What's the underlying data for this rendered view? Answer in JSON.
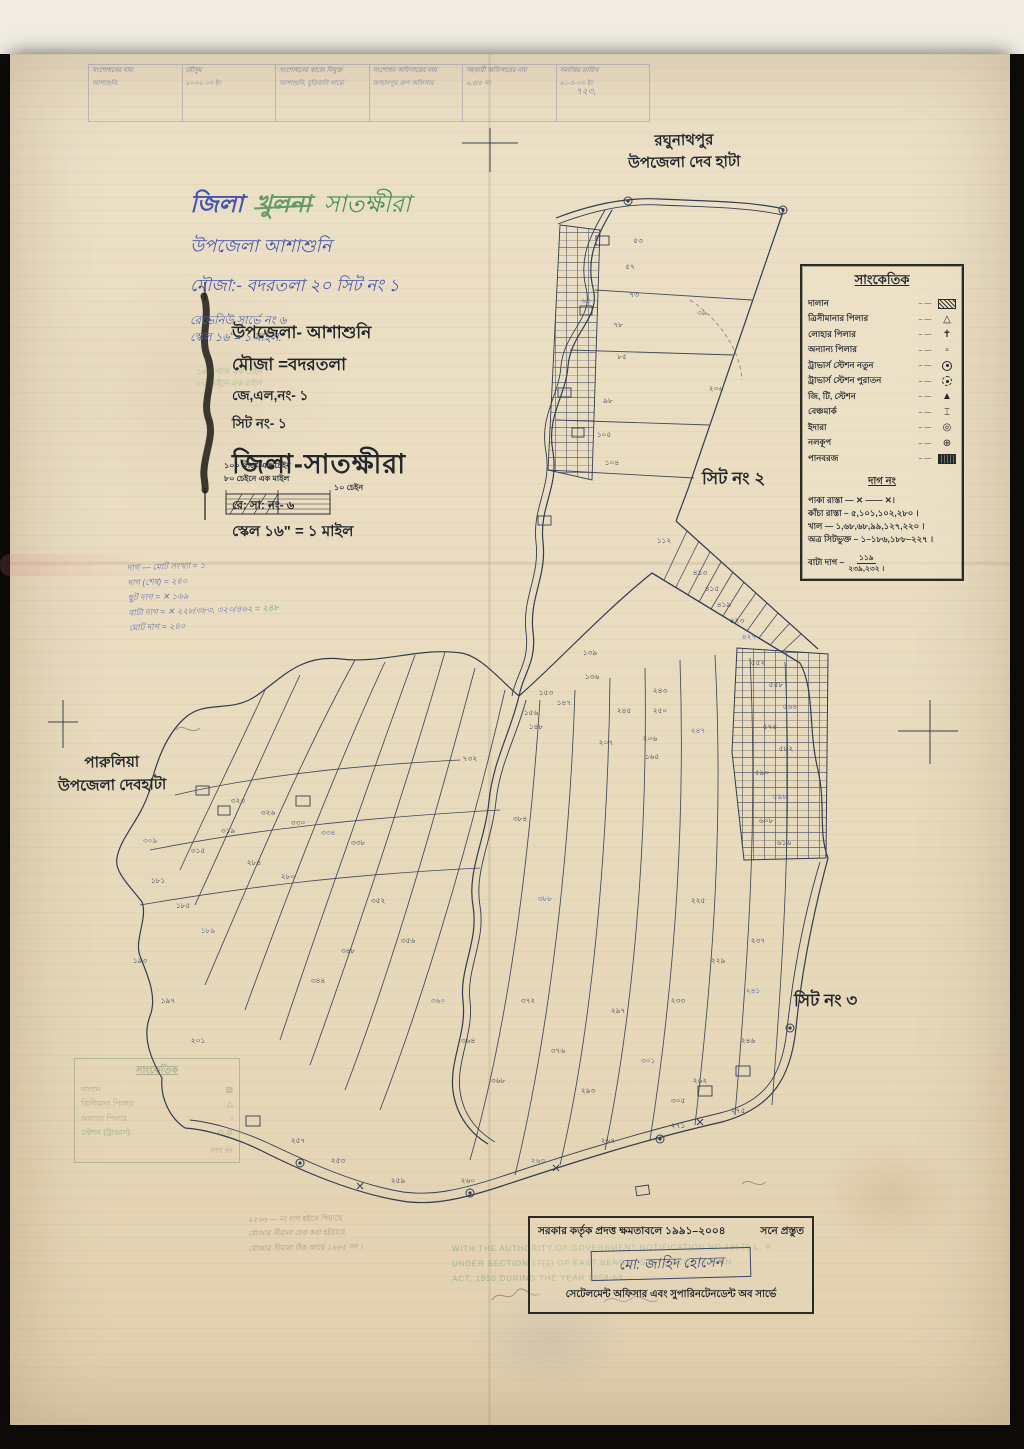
{
  "colors": {
    "ink": "#323c52",
    "blue": "#4a5fae",
    "green": "#3f8a52",
    "paper": "#e9dcc1"
  },
  "annot_table": {
    "dots": "–  —",
    "cells": [
      {
        "top": "সংশোধনের নাম:",
        "bottom": "আশাশুনি:"
      },
      {
        "top": "মৌসুম",
        "bottom": "২০০২-০৩ ইং"
      },
      {
        "top": "সংশোধনের কাজে নিযুক্ত",
        "bottom": "আশাশুনি, বুড়িবাটা সার্ভে"
      },
      {
        "top": "সংশোধন অফিসারের নাম",
        "bottom": "জাহানপুর গ্রুপ অফিসার"
      },
      {
        "top": "সহকারী অফিসারের নাম",
        "bottom": "৬,৫/৫ নং"
      },
      {
        "top": "সমাপ্তির তারিখ",
        "bottom": "৬১-৪-০৩ ইং"
      }
    ],
    "extra": "৭২৩,"
  },
  "hand_title": {
    "district_label": "জিলা",
    "old_district": "খুলনা",
    "new_district": "সাতক্ষীরা",
    "line2": "উপজেলা আশাশুনি",
    "line3": "মৌজা:- বদরতলা ২০ সিট নং ১",
    "rev1": "রেভেনিউ সার্ভে নং ৬",
    "rev2": "স্কেল ১৬\"= ১ মাইল."
  },
  "print_title": {
    "upazila": "উপজেলা- আশাশুনি",
    "mouza": "মৌজা =বদরতলা",
    "jl": "জে,এল,নং- ১",
    "sheet": "সিট নং- ১",
    "district": "জিলা-সাতক্ষীরা",
    "rs": "রে: সা: নং- ৬",
    "scale": "স্কেল ১৬\" = ১ মাইল",
    "chain1": "১০০ লিঙ্কে এক চেইন",
    "chain2": "৮০ চেইনে এক মাইল",
    "scalebar_label": "১০ চেইন",
    "ghost1": "১৬০ গজে এক চেইন",
    "ghost2": "৮০ চেইনে এক মাইল"
  },
  "places": {
    "top_right1": "রঘুনাথপুর",
    "top_right2": "উপজেলা দেব হাটা",
    "sheet2": "সিট নং ২",
    "left1": "পারুলিয়া",
    "left2": "উপজেলা দেবহাটা",
    "sheet3": "সিট নং ৩"
  },
  "legend": {
    "title": "সাংকেতিক",
    "dots": "–  —",
    "items": [
      {
        "label": "দালান",
        "sym": "hatch"
      },
      {
        "label": "ত্রিসীমানার পিলার",
        "sym": "tri"
      },
      {
        "label": "লোহার পিলার",
        "sym": "cross"
      },
      {
        "label": "অন্যান্য পিলার",
        "sym": "sq"
      },
      {
        "label": "ট্রাভার্স স্টেশন নতুন",
        "sym": "circdot"
      },
      {
        "label": "ট্রাভার্স স্টেশন পুরাতন",
        "sym": "circdash"
      },
      {
        "label": "জি, টি, স্টেশন",
        "sym": "tridark"
      },
      {
        "label": "বেঞ্চমার্ক",
        "sym": "bench"
      },
      {
        "label": "ইদারা",
        "sym": "well"
      },
      {
        "label": "নলকূপ",
        "sym": "tube"
      },
      {
        "label": "পানবরজ",
        "sym": "darkhatch"
      }
    ],
    "dag_title": "দাগ নং",
    "dag_lines": [
      "পাকা রাস্তা — ✕ —— ✕।",
      "কাঁচা রাস্তা – ৫,১০১,১০২,২৮০ ।",
      "খাল — ১,৬৮,৬৮,৯৯,১২৭,২২০ ।",
      "অত্র সিটভুক্ত – ১–১৮৬,১৮৮–২২৭ ।"
    ],
    "bata_label": "বাটা দাগ –",
    "bata_num": "১১৯",
    "bata_den": "২৩৯,২৩২ ।"
  },
  "blue_notes": [
    "দাগ — মোট সংখ্যা =  ১",
    "দাগ (শেষ) =  ২৪০",
    "ছুট দাগ =  ✕ ১৬৯",
    "বাটা দাগ =  ✕ ২২৮/৩৮৩, ৩২০/৪৬২",
    "মোট দাগ =  ২৪০"
  ],
  "blue_notes_teal": "= ২৪৮",
  "ghost_legend": {
    "title": "সাংকেতিক",
    "rows": [
      {
        "label": "দালান",
        "sym": "▨"
      },
      {
        "label": "ত্রিসীমানা পিলার",
        "sym": "△"
      },
      {
        "label": "অন্যান্য পিলার",
        "sym": "▫"
      },
      {
        "label": "স্টেশন (ট্রাভার্স)",
        "sym": "⊙ ⊙"
      }
    ],
    "footer": "দাগ নং"
  },
  "stamp": {
    "line1": "সরকার কর্তৃক প্রদত্ত ক্ষমতাবলে ১৯৯১–২০০৪",
    "line1b": "সনে প্রস্তুত",
    "name": "মো: জাহিদ হোসেন",
    "line3": "সেটেলমেন্ট অফিসার এবং সুপারিনটেনডেন্ট অব সার্ভে",
    "ghost_lines": [
      "WITH THE AUTHORITY OF GOVERNMENT NOTIFICATION NO 19636 L. R.",
      "UNDER SECTION 17(1) OF EAST BENGAL STATE ACQUISITION",
      "ACT, 1950 DURING THE YEAR 1958-63"
    ]
  },
  "pencil_notes": [
    "২২৬৬ — নং দাগ হইতে গিয়াছে",
    "মৌজার সীমানা চেক করা হইয়াছে",
    "মৌজার সীমানা ঠিক আছে ১৯৬৫ সন ।"
  ],
  "map": {
    "labels": [
      {
        "x": 638,
        "y": 242,
        "t": "৫৩"
      },
      {
        "x": 630,
        "y": 268,
        "t": "৫৭"
      },
      {
        "x": 634,
        "y": 296,
        "t": "৭৩"
      },
      {
        "x": 618,
        "y": 326,
        "t": "৭৮"
      },
      {
        "x": 622,
        "y": 358,
        "t": "৮৫"
      },
      {
        "x": 608,
        "y": 402,
        "t": "৯৮"
      },
      {
        "x": 604,
        "y": 436,
        "t": "১০৫"
      },
      {
        "x": 612,
        "y": 464,
        "t": "১০৪"
      },
      {
        "x": 702,
        "y": 314,
        "t": "৩৯",
        "c": "u"
      },
      {
        "x": 716,
        "y": 390,
        "t": "২০৬"
      },
      {
        "x": 664,
        "y": 542,
        "t": "১১২"
      },
      {
        "x": 586,
        "y": 302,
        "t": "৬৩",
        "c": "u"
      },
      {
        "x": 700,
        "y": 574,
        "t": "৪১৩"
      },
      {
        "x": 712,
        "y": 590,
        "t": "৪১৫"
      },
      {
        "x": 724,
        "y": 606,
        "t": "৪১৯"
      },
      {
        "x": 737,
        "y": 622,
        "t": "৪২৩"
      },
      {
        "x": 749,
        "y": 638,
        "t": "৪২৭",
        "c": "u"
      },
      {
        "x": 758,
        "y": 664,
        "t": "৫৫২"
      },
      {
        "x": 776,
        "y": 686,
        "t": "৫৫৮"
      },
      {
        "x": 790,
        "y": 708,
        "t": "৫৬৪",
        "c": "u"
      },
      {
        "x": 770,
        "y": 728,
        "t": "৫৭৪"
      },
      {
        "x": 786,
        "y": 750,
        "t": "৫৮২"
      },
      {
        "x": 762,
        "y": 774,
        "t": "৫৯০"
      },
      {
        "x": 780,
        "y": 798,
        "t": "৫৯৮",
        "c": "u"
      },
      {
        "x": 766,
        "y": 822,
        "t": "৬০৮"
      },
      {
        "x": 784,
        "y": 844,
        "t": "৬১৬"
      },
      {
        "x": 590,
        "y": 654,
        "t": "১৩৯"
      },
      {
        "x": 592,
        "y": 678,
        "t": "১৩৬"
      },
      {
        "x": 546,
        "y": 694,
        "t": "১৫৩"
      },
      {
        "x": 564,
        "y": 704,
        "t": "১৪৭"
      },
      {
        "x": 531,
        "y": 714,
        "t": "১৫৬"
      },
      {
        "x": 536,
        "y": 728,
        "t": "১৪৮"
      },
      {
        "x": 660,
        "y": 692,
        "t": "২৪৩"
      },
      {
        "x": 624,
        "y": 712,
        "t": "২৪৫"
      },
      {
        "x": 660,
        "y": 712,
        "t": "২৫০"
      },
      {
        "x": 650,
        "y": 740,
        "t": "২০৬"
      },
      {
        "x": 652,
        "y": 758,
        "t": "১৬৫"
      },
      {
        "x": 698,
        "y": 732,
        "t": "২৪৭",
        "c": "u"
      },
      {
        "x": 606,
        "y": 744,
        "t": "২০৭"
      },
      {
        "x": 238,
        "y": 802,
        "t": "৩২৩"
      },
      {
        "x": 268,
        "y": 814,
        "t": "৩২৬"
      },
      {
        "x": 298,
        "y": 824,
        "t": "৩৩০"
      },
      {
        "x": 328,
        "y": 834,
        "t": "৩৩৪",
        "c": "u"
      },
      {
        "x": 358,
        "y": 844,
        "t": "৩৩৮"
      },
      {
        "x": 228,
        "y": 832,
        "t": "৩১৯"
      },
      {
        "x": 198,
        "y": 852,
        "t": "৩১৫"
      },
      {
        "x": 254,
        "y": 864,
        "t": "২৮৪"
      },
      {
        "x": 288,
        "y": 878,
        "t": "২৮০"
      },
      {
        "x": 183,
        "y": 907,
        "t": "১৮৫"
      },
      {
        "x": 208,
        "y": 932,
        "t": "১৮৯",
        "c": "u"
      },
      {
        "x": 150,
        "y": 842,
        "t": "৩০৯",
        "c": "u"
      },
      {
        "x": 158,
        "y": 882,
        "t": "১৮১"
      },
      {
        "x": 140,
        "y": 962,
        "t": "১৯৩"
      },
      {
        "x": 168,
        "y": 1002,
        "t": "১৯৭"
      },
      {
        "x": 198,
        "y": 1042,
        "t": "২০১"
      },
      {
        "x": 378,
        "y": 902,
        "t": "৩৫২"
      },
      {
        "x": 408,
        "y": 942,
        "t": "৩৫৬"
      },
      {
        "x": 348,
        "y": 952,
        "t": "৩৪৮"
      },
      {
        "x": 318,
        "y": 982,
        "t": "৩৪৪"
      },
      {
        "x": 438,
        "y": 1002,
        "t": "৩৬০",
        "c": "u"
      },
      {
        "x": 468,
        "y": 1042,
        "t": "৩৬৪"
      },
      {
        "x": 498,
        "y": 1082,
        "t": "৩৬৮"
      },
      {
        "x": 528,
        "y": 1002,
        "t": "৩৭২"
      },
      {
        "x": 558,
        "y": 1052,
        "t": "৩৭৬"
      },
      {
        "x": 588,
        "y": 1092,
        "t": "২৯৩"
      },
      {
        "x": 618,
        "y": 1012,
        "t": "২৯৭"
      },
      {
        "x": 648,
        "y": 1062,
        "t": "৩০১",
        "c": "u"
      },
      {
        "x": 678,
        "y": 1102,
        "t": "৩০৫"
      },
      {
        "x": 698,
        "y": 902,
        "t": "২২৫"
      },
      {
        "x": 718,
        "y": 962,
        "t": "২২৯"
      },
      {
        "x": 678,
        "y": 1002,
        "t": "২৩৩"
      },
      {
        "x": 758,
        "y": 942,
        "t": "২৩৭"
      },
      {
        "x": 753,
        "y": 992,
        "t": "২৪১",
        "c": "u"
      },
      {
        "x": 748,
        "y": 1042,
        "t": "২৪৬"
      },
      {
        "x": 298,
        "y": 1142,
        "t": "২৫৭"
      },
      {
        "x": 338,
        "y": 1162,
        "t": "২৫৩"
      },
      {
        "x": 398,
        "y": 1182,
        "t": "২৫৯"
      },
      {
        "x": 468,
        "y": 1182,
        "t": "২৬০"
      },
      {
        "x": 538,
        "y": 1162,
        "t": "২৬৩",
        "c": "u"
      },
      {
        "x": 608,
        "y": 1142,
        "t": "২৬৭"
      },
      {
        "x": 678,
        "y": 1127,
        "t": "২৭১"
      },
      {
        "x": 738,
        "y": 1112,
        "t": "২৭৫"
      },
      {
        "x": 700,
        "y": 1082,
        "t": "২৬২"
      },
      {
        "x": 470,
        "y": 760,
        "t": "৭৩২"
      },
      {
        "x": 520,
        "y": 820,
        "t": "৩৮৪"
      },
      {
        "x": 545,
        "y": 900,
        "t": "৩৮৮",
        "c": "u"
      }
    ]
  }
}
